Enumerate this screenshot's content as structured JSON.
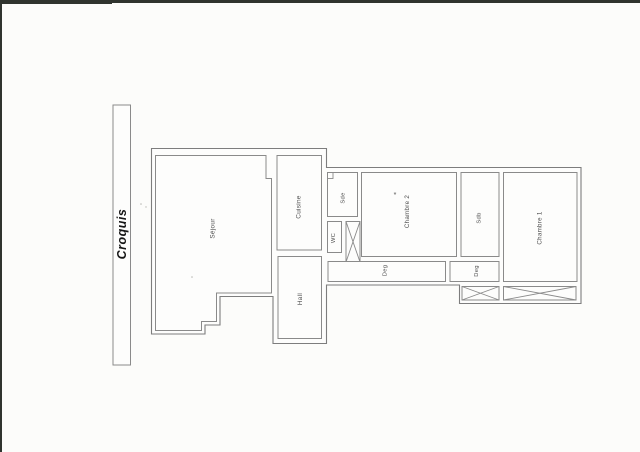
{
  "document": {
    "type": "scanned floor plan sketch",
    "language": "fr"
  },
  "sidebar_label": {
    "text": "Croquis"
  },
  "floor_plan": {
    "rooms": [
      {
        "id": "sejour",
        "label": "Séjour"
      },
      {
        "id": "cuisine",
        "label": "Cuisine"
      },
      {
        "id": "hall",
        "label": "Hall"
      },
      {
        "id": "sde",
        "label": "Sde"
      },
      {
        "id": "wc",
        "label": "WC"
      },
      {
        "id": "chambre2",
        "label": "Chambre 2"
      },
      {
        "id": "sdb",
        "label": "Sdb"
      },
      {
        "id": "chambre1",
        "label": "Chambre 1"
      },
      {
        "id": "deg1",
        "label": "Deg"
      },
      {
        "id": "deg2",
        "label": "Deg"
      }
    ],
    "annotation_mark": "*"
  },
  "colors": {
    "paper": "#fcfcfa",
    "plan_fill": "#fdfdfc",
    "wall": "#8a8a8a",
    "outer_wall": "#7d7d7d",
    "label_text": "#4f4f4f",
    "croquis_text": "#161616",
    "scan_edge": "#30342e"
  }
}
